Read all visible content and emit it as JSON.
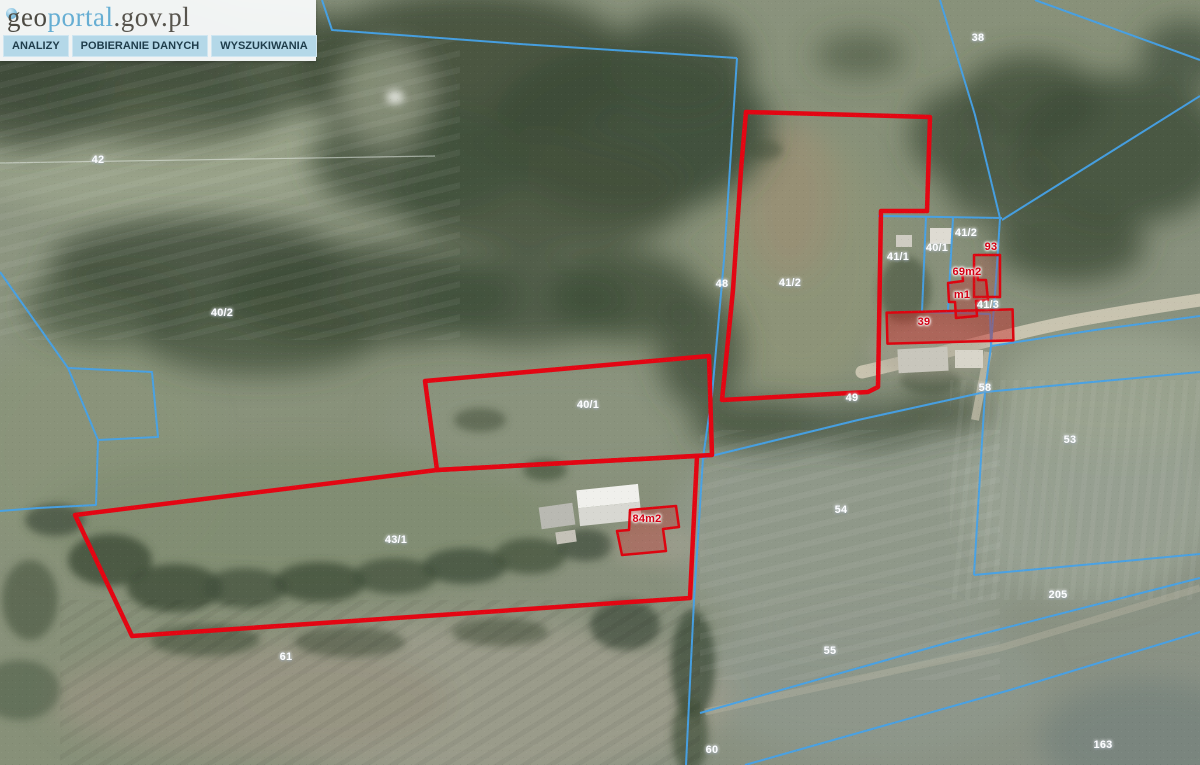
{
  "header": {
    "logo": {
      "geo": "geo",
      "portal": "portal",
      "suffix": ".gov.pl"
    },
    "menu": [
      {
        "id": "analizy",
        "label": "ANALIZY"
      },
      {
        "id": "pobieranie-danych",
        "label": "POBIERANIE DANYCH"
      },
      {
        "id": "wyszukiwania",
        "label": "WYSZUKIWANIA"
      }
    ]
  },
  "map": {
    "type": "aerial-orthophoto-with-cadastral-overlay",
    "colors": {
      "parcel_boundary": "#46a2e8",
      "selection_outline": "#e30613",
      "selection_fill": "rgba(205,25,25,0.32)",
      "label_white": "#ffffff",
      "label_red": "#d30014",
      "road": "#d4ccb8"
    },
    "parcel_labels": [
      {
        "text": "42",
        "x": 98,
        "y": 160,
        "color": "white"
      },
      {
        "text": "38",
        "x": 978,
        "y": 38,
        "color": "white"
      },
      {
        "text": "40/2",
        "x": 222,
        "y": 313,
        "color": "white"
      },
      {
        "text": "48",
        "x": 722,
        "y": 284,
        "color": "white"
      },
      {
        "text": "41/2",
        "x": 790,
        "y": 283,
        "color": "white"
      },
      {
        "text": "41/2",
        "x": 966,
        "y": 233,
        "color": "white"
      },
      {
        "text": "40/1",
        "x": 937,
        "y": 248,
        "color": "white"
      },
      {
        "text": "41/1",
        "x": 898,
        "y": 257,
        "color": "white"
      },
      {
        "text": "41/3",
        "x": 988,
        "y": 305,
        "color": "white"
      },
      {
        "text": "40/1",
        "x": 588,
        "y": 405,
        "color": "white"
      },
      {
        "text": "49",
        "x": 852,
        "y": 398,
        "color": "white"
      },
      {
        "text": "58",
        "x": 985,
        "y": 388,
        "color": "white"
      },
      {
        "text": "53",
        "x": 1070,
        "y": 440,
        "color": "white"
      },
      {
        "text": "54",
        "x": 841,
        "y": 510,
        "color": "white"
      },
      {
        "text": "43/1",
        "x": 396,
        "y": 540,
        "color": "white"
      },
      {
        "text": "55",
        "x": 830,
        "y": 651,
        "color": "white"
      },
      {
        "text": "205",
        "x": 1058,
        "y": 595,
        "color": "white"
      },
      {
        "text": "61",
        "x": 286,
        "y": 657,
        "color": "white"
      },
      {
        "text": "60",
        "x": 712,
        "y": 750,
        "color": "white"
      },
      {
        "text": "163",
        "x": 1103,
        "y": 745,
        "color": "white"
      },
      {
        "text": "93",
        "x": 991,
        "y": 247,
        "color": "red"
      },
      {
        "text": "69m2",
        "x": 967,
        "y": 272,
        "color": "red"
      },
      {
        "text": "m1",
        "x": 962,
        "y": 295,
        "color": "red"
      },
      {
        "text": "39",
        "x": 924,
        "y": 322,
        "color": "red"
      },
      {
        "text": "84m2",
        "x": 647,
        "y": 519,
        "color": "red"
      }
    ]
  }
}
